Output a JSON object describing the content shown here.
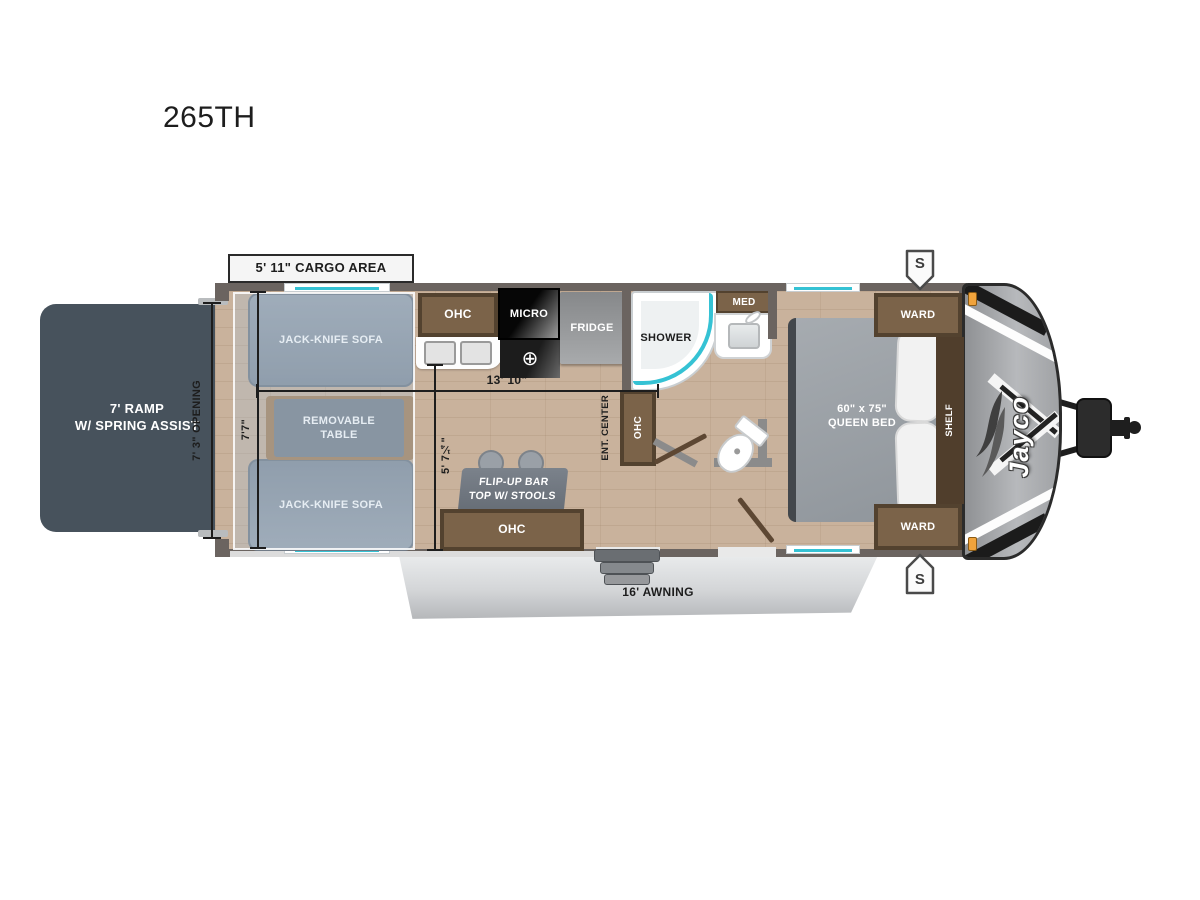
{
  "page": {
    "title": "265TH",
    "brand_logo": "Jayco"
  },
  "dimensions": {
    "cargo_area": "5' 11\" CARGO AREA",
    "opening": "7' 3\" OPENING",
    "garage_width": "7'7\"",
    "main_length": "13' 10\"",
    "galley_width": "5' 7¼\"",
    "awning": "16' AWNING"
  },
  "rooms": {
    "ramp": "7' RAMP\nW/ SPRING ASSIST",
    "sofa_top": "JACK-KNIFE SOFA",
    "sofa_bottom": "JACK-KNIFE SOFA",
    "table": "REMOVABLE\nTABLE",
    "ohc_kitchen": "OHC",
    "micro": "MICRO",
    "fridge": "FRIDGE",
    "shower": "SHOWER",
    "med": "MED",
    "ent_center": "ENT. CENTER",
    "ohc_ent": "OHC",
    "bar": "FLIP-UP BAR\nTOP W/ STOOLS",
    "ohc_bar": "OHC",
    "bed": "60\" x 75\"\nQUEEN BED",
    "ward_top": "WARD",
    "ward_bottom": "WARD",
    "shelf": "SHELF"
  },
  "icons": {
    "speaker": "S",
    "burner": "⊕"
  },
  "colors": {
    "accent_teal": "#35c2d4",
    "ramp": "#47525c",
    "walls": "#6b6460",
    "floor": "#c9b29c",
    "cabinet_brown": "#6b553f",
    "sofa_gray": "#8d97a3",
    "awning_gray": "#d9dbdd",
    "front_cap": "#a5a7aa",
    "marker_light": "#f0a33c"
  }
}
